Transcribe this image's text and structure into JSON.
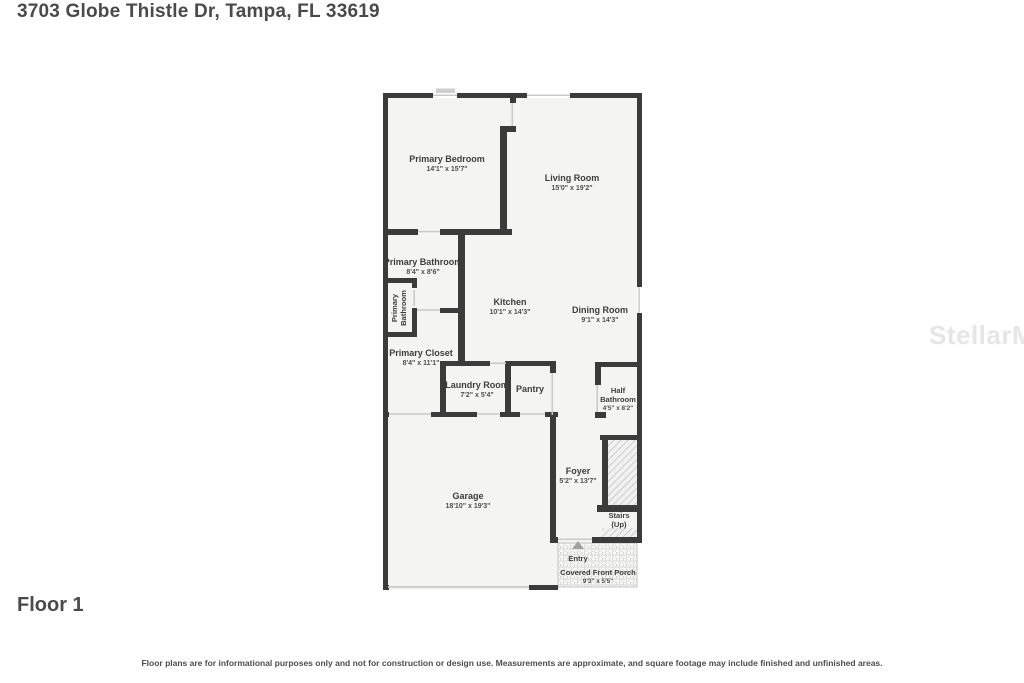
{
  "page": {
    "title": "3703 Globe Thistle Dr, Tampa, FL 33619",
    "floor_label": "Floor 1",
    "disclaimer": "Floor plans are for informational purposes only and not for construction or design use. Measurements are approximate, and square footage may include finished and unfinished areas.",
    "watermark": "StellarMLS"
  },
  "colors": {
    "wall": "#3b3b3b",
    "room_fill": "#f4f4f3",
    "opening_line": "#c9c9c9",
    "label_text": "#3d3d3d",
    "title_text": "#4a4a4a",
    "entry_arrow": "#a0a0a0"
  },
  "rooms": {
    "primary_bedroom": {
      "name": "Primary Bedroom",
      "dims": "14'1\" x 15'7\""
    },
    "living_room": {
      "name": "Living Room",
      "dims": "15'0\" x 19'2\""
    },
    "primary_bathroom": {
      "name": "Primary Bathroom",
      "dims": "8'4\" x 8'6\""
    },
    "primary_bathroom_wc": {
      "line1": "Primary",
      "line2": "Bathroom"
    },
    "primary_closet": {
      "name": "Primary Closet",
      "dims": "8'4\" x 11'1\""
    },
    "kitchen": {
      "name": "Kitchen",
      "dims": "10'1\" x 14'3\""
    },
    "dining_room": {
      "name": "Dining Room",
      "dims": "9'1\" x 14'3\""
    },
    "laundry_room": {
      "name": "Laundry Room",
      "dims": "7'2\" x 5'4\""
    },
    "pantry": {
      "name": "Pantry"
    },
    "half_bathroom": {
      "line1": "Half",
      "line2": "Bathroom",
      "dims": "4'5\" x 8'2\""
    },
    "foyer": {
      "name": "Foyer",
      "dims": "5'2\" x 13'7\""
    },
    "garage": {
      "name": "Garage",
      "dims": "18'10\" x 19'3\""
    },
    "stairs": {
      "line1": "Stairs",
      "line2": "(Up)"
    },
    "entry": {
      "name": "Entry"
    },
    "covered_front_porch": {
      "name": "Covered Front Porch",
      "dims": "9'3\" x 5'5\""
    }
  }
}
